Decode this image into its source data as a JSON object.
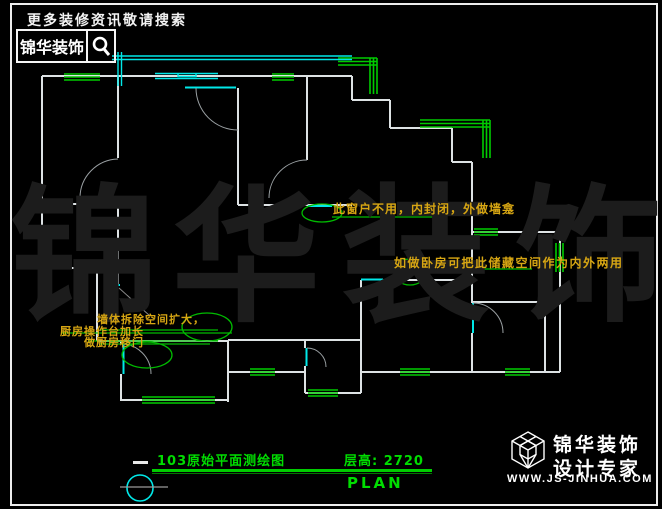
{
  "header": {
    "search_hint": "更多装修资讯敬请搜索",
    "brand": "锦华装饰"
  },
  "watermark": {
    "chars": [
      "锦",
      "华",
      "装",
      "饰"
    ]
  },
  "annotations": {
    "window_note": "此窗户不用，内封闭，外做墙龛",
    "storage_note": "如做卧房可把此储藏空间作为内外两用",
    "kitchen_note_line1": "墙体拆除空间扩大，",
    "kitchen_note_line2": "厨房操作台加长",
    "kitchen_note_line3": "做厨房移门"
  },
  "title_block": {
    "title": "103原始平面测绘图",
    "floor_height": "层高: 2720",
    "plan_label": "PLAN"
  },
  "footer": {
    "brand": "锦华装饰",
    "tagline": "设计专家",
    "website": "WWW.JS-JINHUA.COM"
  },
  "colors": {
    "background": "#000000",
    "wall": "#dde2e4",
    "window_green": "#00cc00",
    "cad_cyan": "#00e8e8",
    "annotation_yellow": "#d7a613",
    "title_green": "#00dd00",
    "watermark_gray": "#1c1c1c"
  }
}
